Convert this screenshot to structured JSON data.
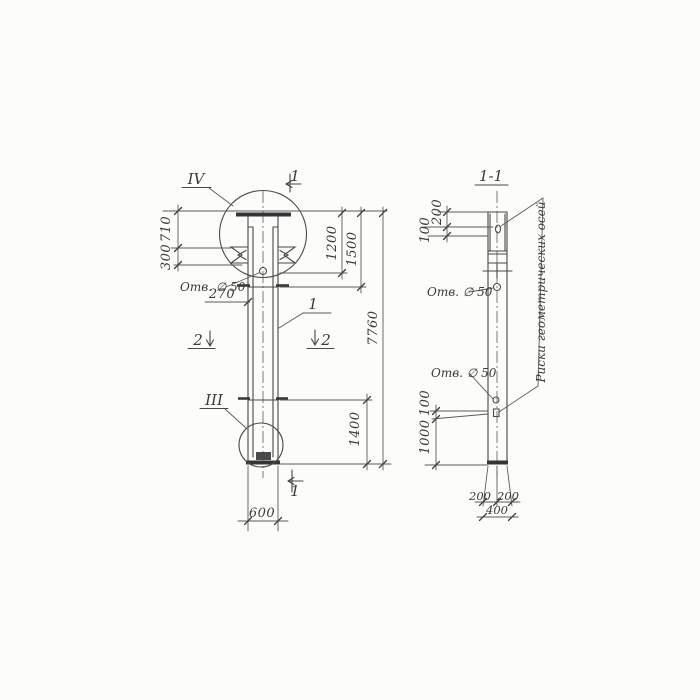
{
  "colors": {
    "paper": "#fcfcfa",
    "ink": "#474747"
  },
  "left_view": {
    "detail_marker_top": "IV",
    "detail_marker_bottom": "III",
    "cut_mark_top": "1",
    "cut_mark_bottom": "1",
    "cut_mark_left": "2",
    "cut_mark_right": "2",
    "item_label": "1",
    "hole_label": "Отв. ∅ 50",
    "dim_710": "710",
    "dim_300": "300",
    "dim_270": "270",
    "dim_1200": "1200",
    "dim_1500": "1500",
    "dim_7760": "7760",
    "dim_1400": "1400",
    "dim_600": "600"
  },
  "section_view": {
    "title": "1-1",
    "hole_label_top": "Отв. ∅ 50",
    "hole_label_bottom": "Отв. ∅ 50",
    "axes_note": "Риски геометрических осей",
    "dim_200_top": "200",
    "dim_100_top": "100",
    "dim_100_bottom": "100",
    "dim_1000": "1000",
    "dim_200_bottom_left": "200",
    "dim_200_bottom_right": "200",
    "dim_400": "400"
  }
}
